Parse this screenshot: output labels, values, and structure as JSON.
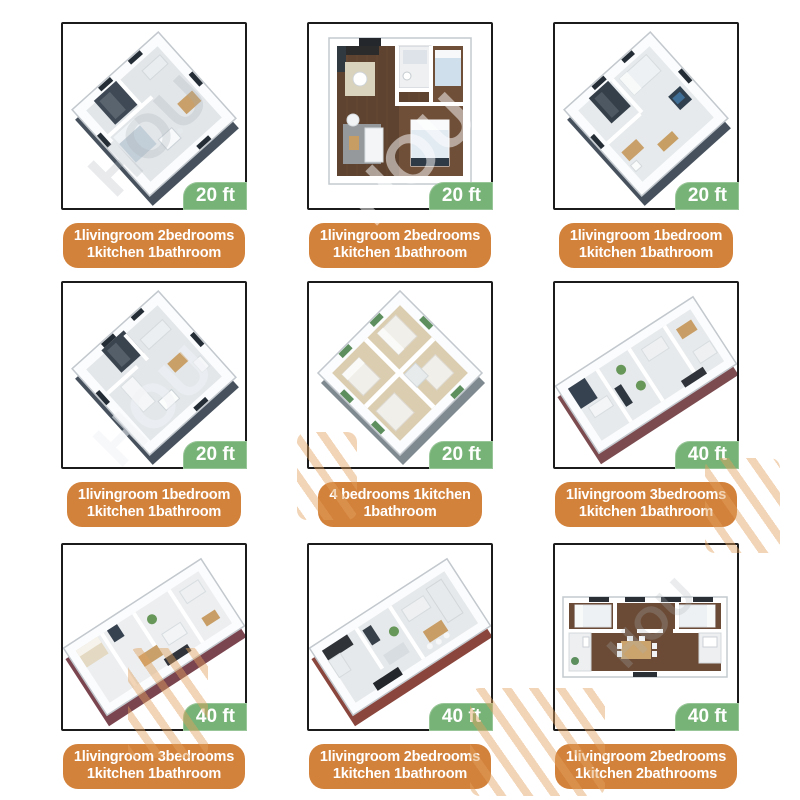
{
  "watermark": {
    "text": "HOU"
  },
  "colors": {
    "badge_bg": "#77b377",
    "badge_text": "#ffffff",
    "label_bg": "#d3823c",
    "label_text": "#ffffff",
    "box_border": "#1b1b1b"
  },
  "cards": [
    {
      "plan_type": "iso-square-a",
      "view": "isometric-3d",
      "size_label": "20 ft",
      "description_line1": "1livingroom 2bedrooms",
      "description_line2": "1kitchen 1bathroom"
    },
    {
      "plan_type": "top-square",
      "view": "top-down",
      "size_label": "20 ft",
      "description_line1": "1livingroom 2bedrooms",
      "description_line2": "1kitchen 1bathroom"
    },
    {
      "plan_type": "iso-square-b",
      "view": "isometric-3d",
      "size_label": "20 ft",
      "description_line1": "1livingroom 1bedroom",
      "description_line2": "1kitchen 1bathroom"
    },
    {
      "plan_type": "iso-square-c",
      "view": "isometric-3d",
      "size_label": "20 ft",
      "description_line1": "1livingroom 1bedroom",
      "description_line2": "1kitchen 1bathroom"
    },
    {
      "plan_type": "iso-diamond",
      "view": "isometric-3d",
      "size_label": "20 ft",
      "description_line1": "4 bedrooms 1kitchen",
      "description_line2": "1bathroom"
    },
    {
      "plan_type": "iso-rect-a",
      "view": "isometric-3d",
      "size_label": "40 ft",
      "description_line1": "1livingroom 3bedrooms",
      "description_line2": "1kitchen 1bathroom"
    },
    {
      "plan_type": "iso-rect-b",
      "view": "isometric-3d",
      "size_label": "40 ft",
      "description_line1": "1livingroom 3bedrooms",
      "description_line2": "1kitchen 1bathroom"
    },
    {
      "plan_type": "iso-rect-c",
      "view": "isometric-3d",
      "size_label": "40 ft",
      "description_line1": "1livingroom 2bedrooms",
      "description_line2": "1kitchen 1bathroom"
    },
    {
      "plan_type": "top-rect",
      "view": "top-down",
      "size_label": "40 ft",
      "description_line1": "1livingroom 2bedrooms",
      "description_line2": "1kitchen 2bathrooms"
    }
  ]
}
